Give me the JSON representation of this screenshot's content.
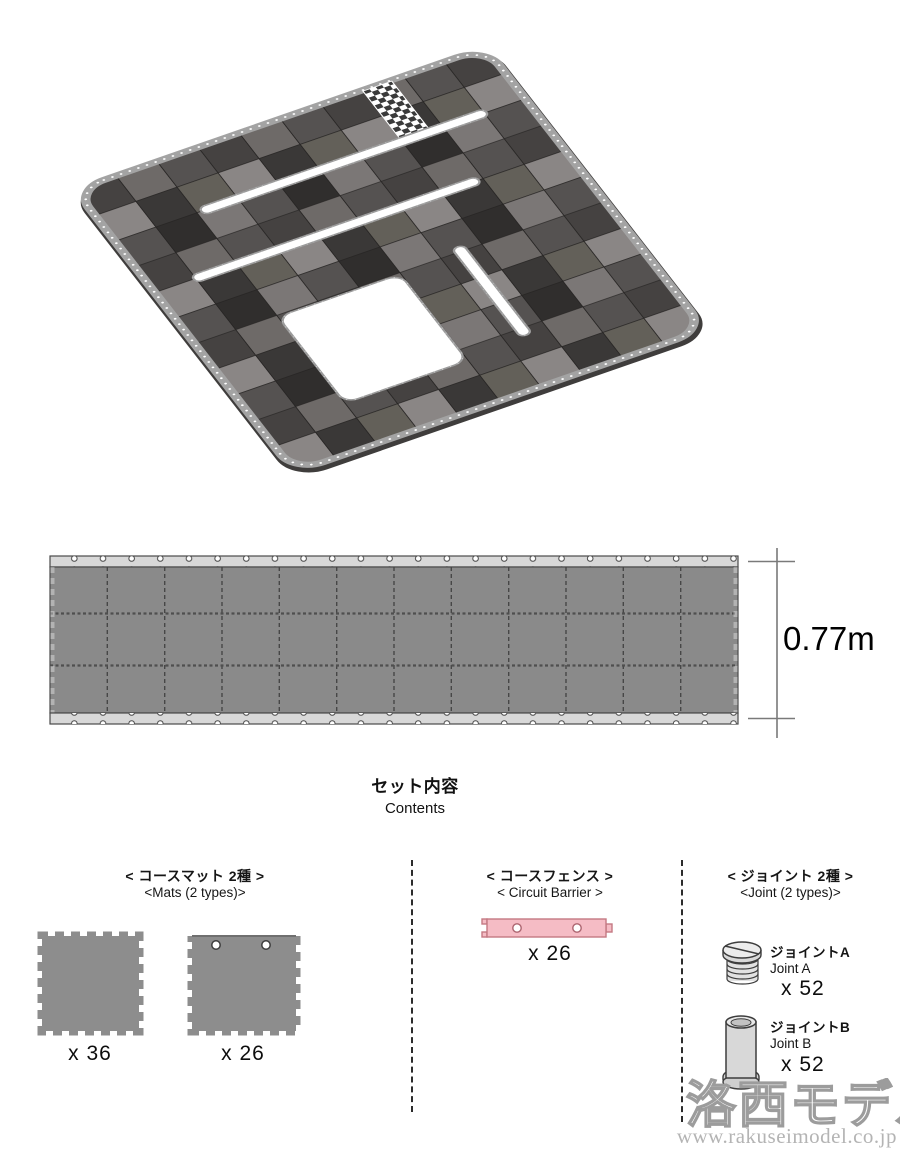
{
  "figure": {
    "dimension_label": "0.77m"
  },
  "contents": {
    "title_jp": "セット内容",
    "title_en": "Contents",
    "sections": {
      "mats": {
        "heading_jp": "< コースマット 2種 >",
        "heading_en": "<Mats (2 types)>",
        "mat_a_count": "x 36",
        "mat_b_count": "x 26"
      },
      "barrier": {
        "heading_jp": "< コースフェンス >",
        "heading_en": "< Circuit Barrier >",
        "count": "x 26"
      },
      "joints": {
        "heading_jp": "< ジョイント 2種 >",
        "heading_en": "<Joint (2 types)>",
        "a": {
          "label_jp": "ジョイントA",
          "label_en": "Joint A",
          "count": "x 52"
        },
        "b": {
          "label_jp": "ジョイントB",
          "label_en": "Joint B",
          "count": "x 52"
        }
      }
    }
  },
  "watermark": {
    "logo": "洛西モデル",
    "url": "www.rakuseimodel.co.jp"
  },
  "colors": {
    "mat_gray": "#8d8d8d",
    "strip_gray": "#8a8a8a",
    "fence_light": "#d8d8d8",
    "barrier_pink": "#f5bcc5",
    "barrier_pink_outline": "#c47983",
    "tile_dark": "#302e2d",
    "tile_light": "#8a8685"
  }
}
